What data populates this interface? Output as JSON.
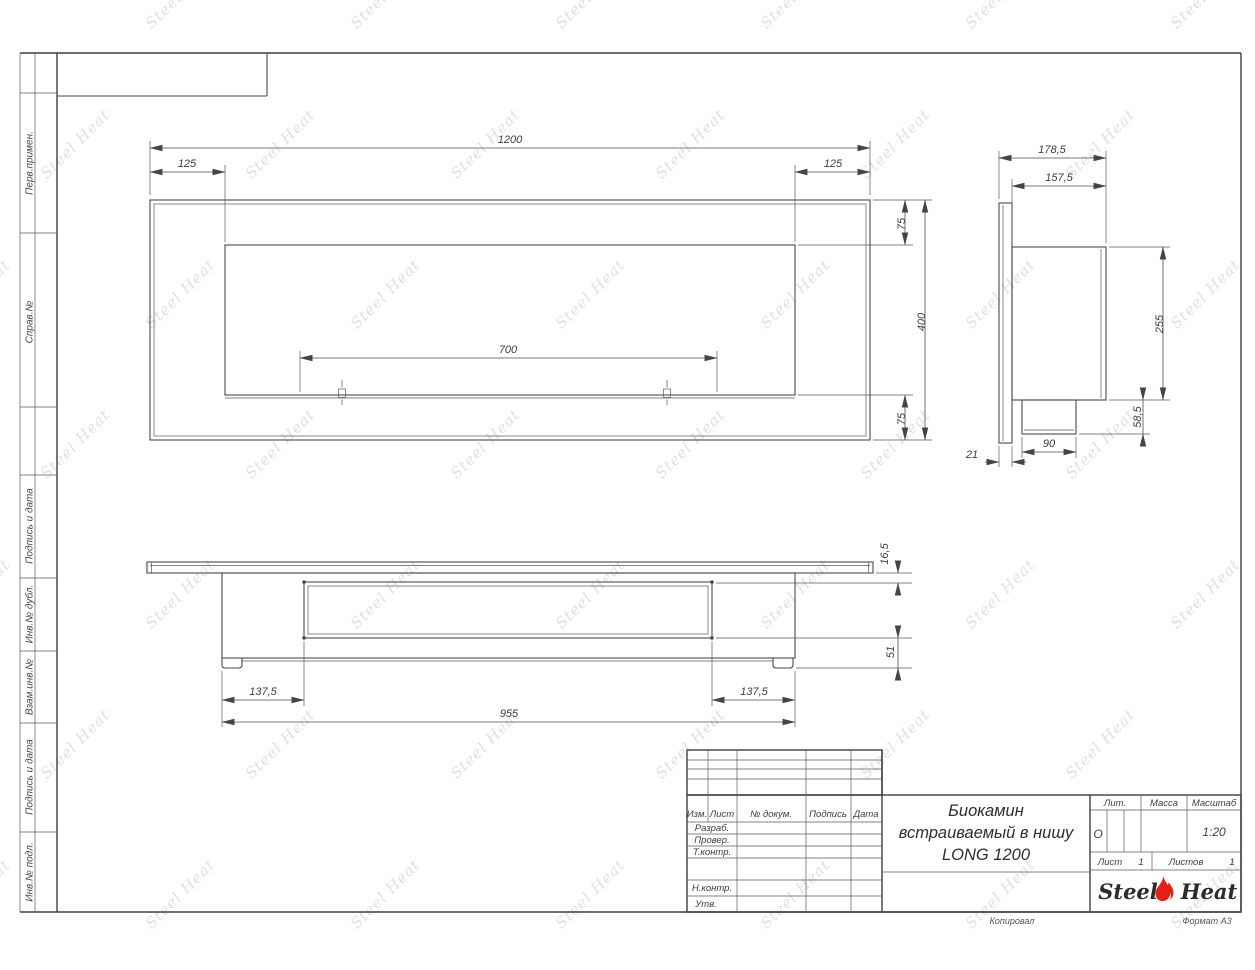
{
  "watermark": {
    "text": "Steel Heat"
  },
  "stamps": {
    "left_labels": [
      "Перв.примен.",
      "Справ.№",
      "Подпись и дата",
      "Инв.№ дубл.",
      "Взам.инв.№",
      "Подпись и дата",
      "Инв.№ подл."
    ]
  },
  "views": {
    "front": {
      "width": "1200",
      "left_inset": "125",
      "right_inset": "125",
      "top_inset": "75",
      "height": "400",
      "bottom_inset": "75",
      "burner_length": "700"
    },
    "side": {
      "depth_total": "178,5",
      "depth_body": "157,5",
      "body_height": "255",
      "spigot_height": "58,5",
      "spigot_width": "90",
      "flange_thickness": "21"
    },
    "plan": {
      "flange_thickness": "16,5",
      "base_height": "51",
      "left_inset": "137,5",
      "right_inset": "137,5",
      "body_width": "955"
    }
  },
  "title_block": {
    "columns": [
      "Изм.",
      "Лист",
      "№ докум.",
      "Подпись",
      "Дата"
    ],
    "rows": [
      "Разраб.",
      "Провер.",
      "Т.контр.",
      "Н.контр.",
      "Утв."
    ],
    "title_lines": [
      "Биокамин",
      "встраиваемый в нишу",
      "LONG 1200"
    ],
    "lit_label": "Лит.",
    "lit_value": "О",
    "mass_label": "Масса",
    "scale_label": "Масштаб",
    "scale_value": "1:20",
    "sheet_label": "Лист",
    "sheet_no": "1",
    "sheets_label": "Листов",
    "sheets_total": "1",
    "logo_left": "Steel",
    "logo_right": "Heat"
  },
  "footer": {
    "copied": "Копировал",
    "format": "Формат А3"
  }
}
